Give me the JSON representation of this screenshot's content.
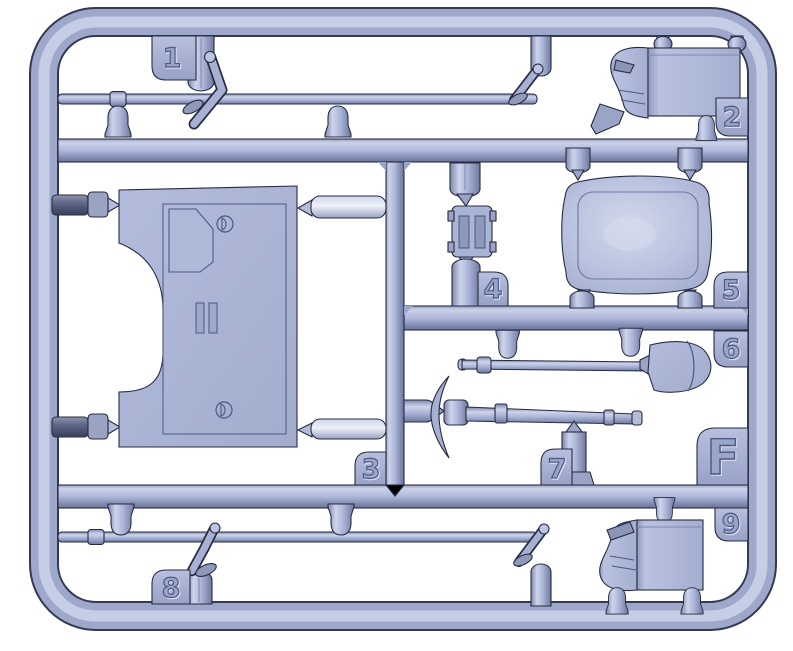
{
  "sprue": {
    "frame_letter": "F",
    "tabs": [
      {
        "label": "1",
        "part": "shift-lever"
      },
      {
        "label": "2",
        "part": "stowage-box"
      },
      {
        "label": "3",
        "part": "hull-panel"
      },
      {
        "label": "4",
        "part": "small-bracket-frame"
      },
      {
        "label": "5",
        "part": "seat-cushion"
      },
      {
        "label": "6",
        "part": "shovel"
      },
      {
        "label": "7",
        "part": "pickaxe"
      },
      {
        "label": "8",
        "part": "shift-lever"
      },
      {
        "label": "9",
        "part": "stowage-box"
      },
      {
        "label": "F",
        "part": "sprue-letter"
      }
    ],
    "colors": {
      "plastic": "#aab4d6",
      "plastic_highlight": "#ccd3ea",
      "plastic_shadow": "#7d87ae",
      "dark_part": "#5c6480",
      "outline": "#272c42",
      "background": "#ffffff"
    }
  }
}
